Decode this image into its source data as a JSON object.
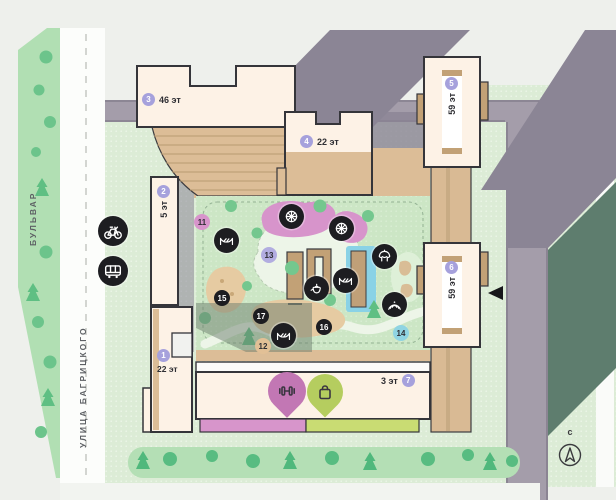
{
  "streets": {
    "boulevard_label": "БУЛЬВАР",
    "street_label": "УЛИЦА БАГРИЦКОГО"
  },
  "compass": {
    "north_letter": "с"
  },
  "buildings": [
    {
      "number": "1",
      "floors": "22 эт"
    },
    {
      "number": "2",
      "floors": "5 эт"
    },
    {
      "number": "3",
      "floors": "46 эт"
    },
    {
      "number": "4",
      "floors": "22 эт"
    },
    {
      "number": "5",
      "floors": "59 эт"
    },
    {
      "number": "6",
      "floors": "59 эт"
    },
    {
      "number": "7",
      "floors": "3 эт"
    }
  ],
  "poi_markers": [
    {
      "number": "11",
      "color": "#d794cb"
    },
    {
      "number": "12",
      "color": "#e2c096"
    },
    {
      "number": "13",
      "color": "#b2ade0"
    },
    {
      "number": "14",
      "color": "#8fd4e2"
    },
    {
      "number": "15",
      "color": "#1d1d21"
    },
    {
      "number": "16",
      "color": "#1d1d21"
    },
    {
      "number": "17",
      "color": "#1d1d21"
    }
  ],
  "amenity_icons": [
    "bicycle-route",
    "bus-stop",
    "carousel",
    "carousel",
    "hammock-lounge",
    "hammock-lounge",
    "hammock-lounge",
    "tea-pavilion",
    "gazebo",
    "amphitheatre"
  ],
  "pins": [
    {
      "name": "fitness",
      "color": "#c277b4"
    },
    {
      "name": "shops",
      "color": "#b5cd5f"
    }
  ],
  "colors": {
    "building_marker": "#a6a1dc",
    "building_fill": "#fdf2e6",
    "terrace_tan": "#dcbd97",
    "greenery": "#b1dfb3",
    "road_gray": "#a49daa",
    "shadow_gray": "#8b8595",
    "shadow_green": "#5e7d6e",
    "pool_blue": "#8ad2e6",
    "playground_pink": "#d794cb",
    "retail_strip_pink": "#d795cb",
    "retail_strip_green": "#c9dc73"
  }
}
